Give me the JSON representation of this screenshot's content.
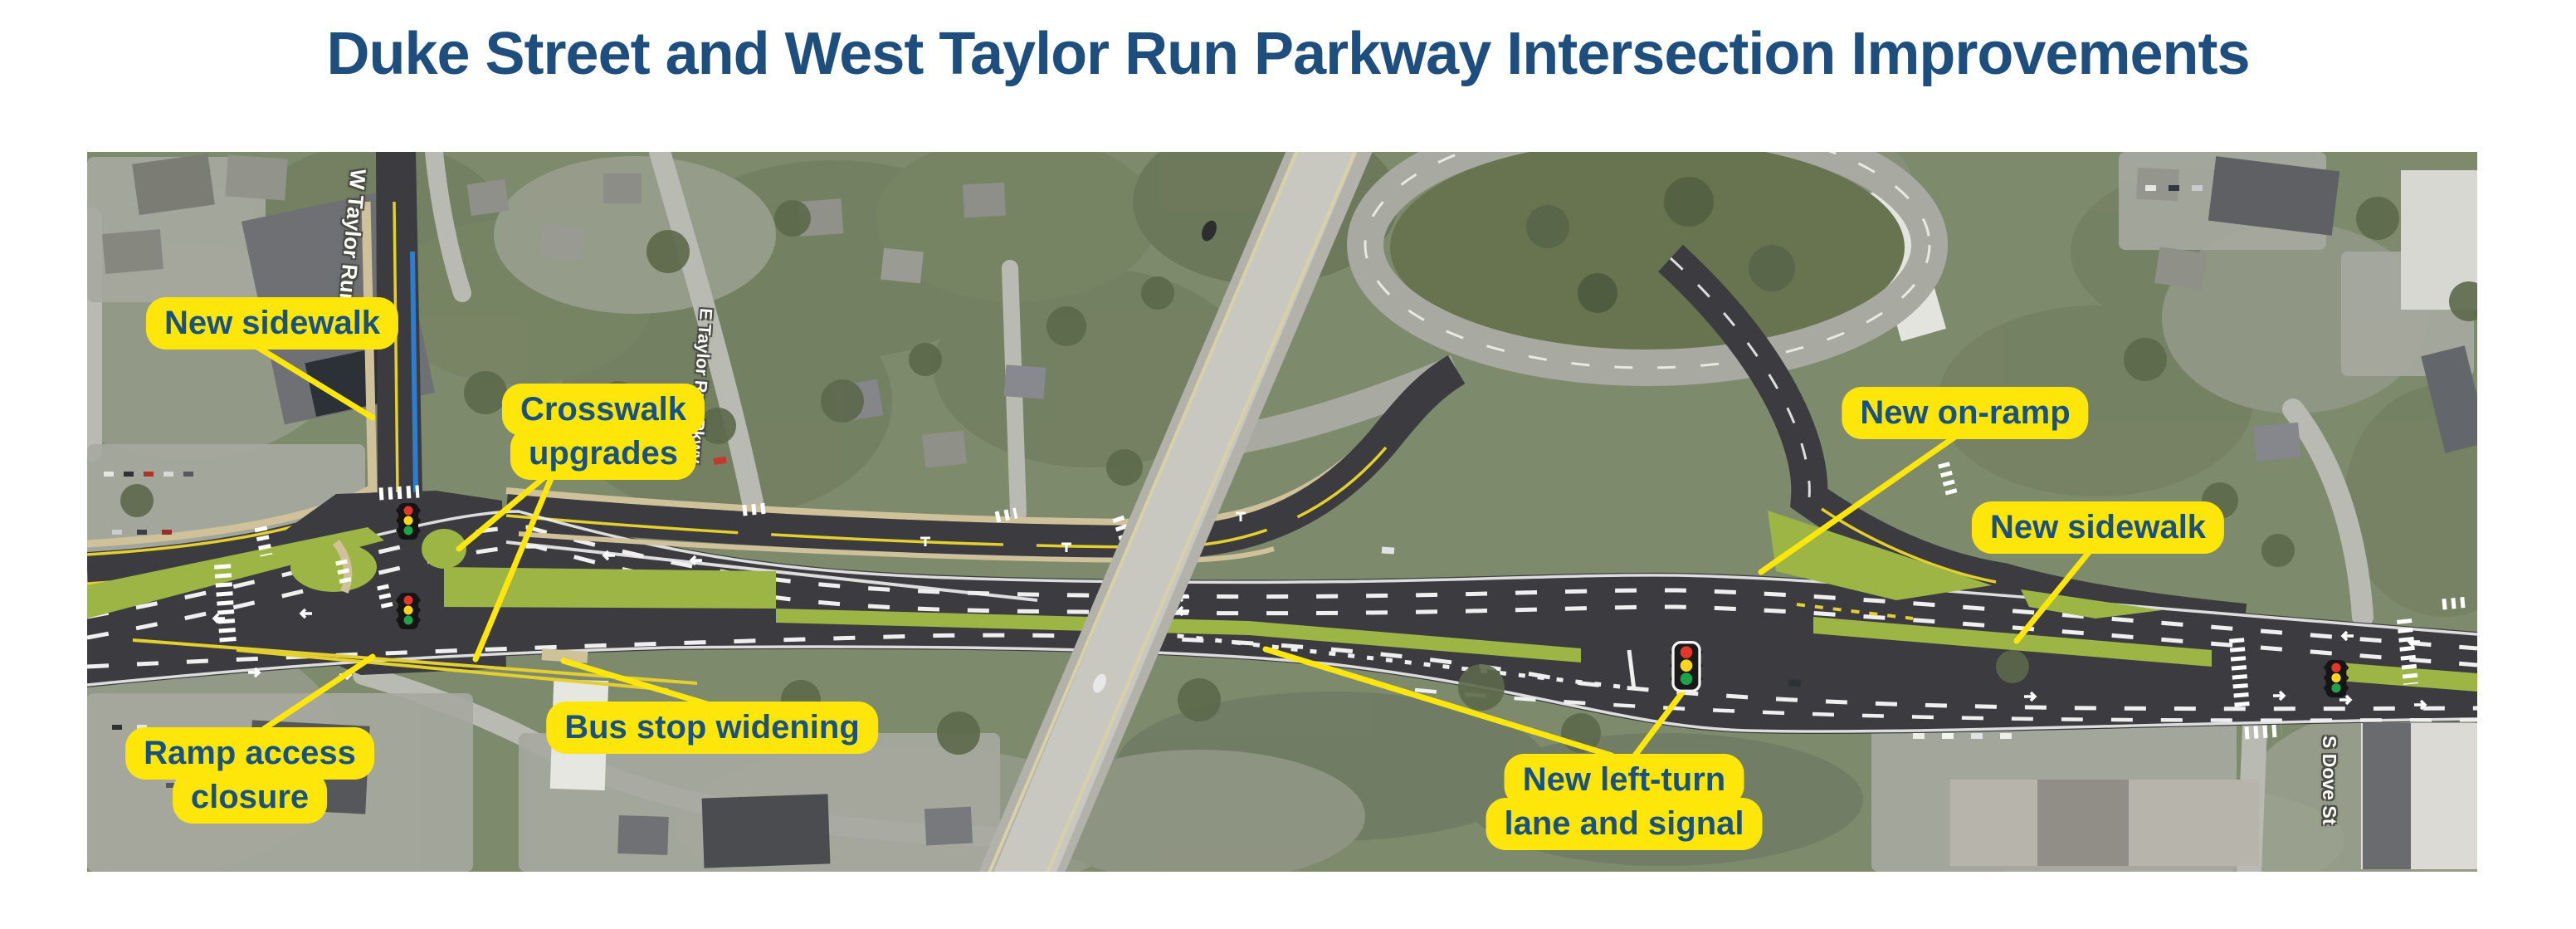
{
  "title": "Duke Street and West Taylor Run Parkway Intersection Improvements",
  "callouts": {
    "new_sidewalk_left": {
      "lines": [
        "New sidewalk"
      ]
    },
    "crosswalk_upgrades": {
      "lines": [
        "Crosswalk",
        "upgrades"
      ]
    },
    "ramp_access_closure": {
      "lines": [
        "Ramp access",
        "closure"
      ]
    },
    "bus_stop_widening": {
      "lines": [
        "Bus stop widening"
      ]
    },
    "new_left_turn_lane_and_signal": {
      "lines": [
        "New left-turn",
        "lane and signal"
      ]
    },
    "new_on_ramp": {
      "lines": [
        "New on-ramp"
      ]
    },
    "new_sidewalk_right": {
      "lines": [
        "New sidewalk"
      ]
    }
  },
  "street_labels": {
    "w_taylor_run": "W Taylor Run",
    "e_taylor_run_pkwy": "E Taylor Run Pkwy",
    "s_dove_st": "S Dove St"
  },
  "map": {
    "description": "Aerial photo of the Duke Street corridor with proposed roadway improvements rendered in dark asphalt, grass medians, crosswalks and traffic signals",
    "traffic_signal_count": 4,
    "traffic_signal_lights": [
      "red",
      "yellow",
      "green"
    ]
  },
  "colors": {
    "title_text": "#1d4e7e",
    "callout_bg": "#ffe60a",
    "callout_text": "#19517f",
    "leader_line": "#ffe60a",
    "rendered_road": "#3b3b40",
    "rendered_grass": "#9db544",
    "new_bike_lane_blue": "#2e7ed0",
    "road_yellow_line": "#e3cf2e"
  }
}
